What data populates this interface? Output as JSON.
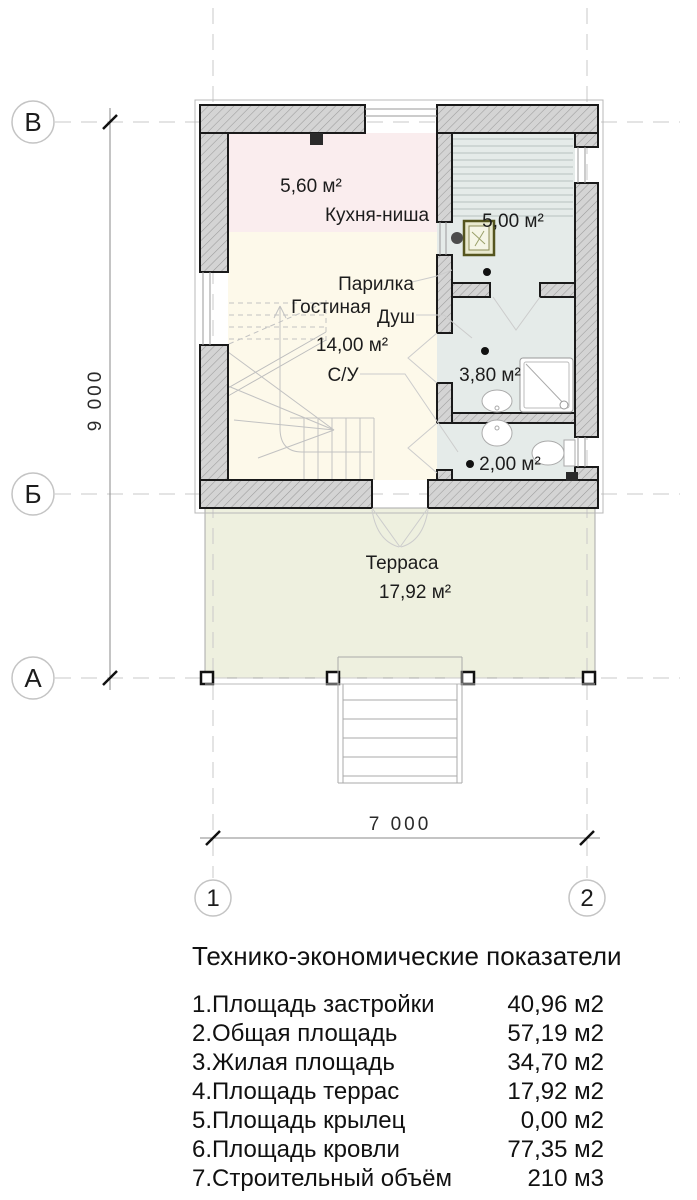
{
  "plan": {
    "axis_rows": [
      {
        "label": "В"
      },
      {
        "label": "Б"
      },
      {
        "label": "А"
      }
    ],
    "axis_cols": [
      {
        "label": "1"
      },
      {
        "label": "2"
      }
    ],
    "dim_height": "9 000",
    "dim_width": "7 000",
    "rooms": [
      {
        "name": "Кухня-ниша",
        "area": "5,60 м²"
      },
      {
        "name": "Парилка",
        "area": "5,00 м²"
      },
      {
        "name": "Гостиная",
        "area": "14,00 м²"
      },
      {
        "name": "Душ",
        "area": "3,80 м²"
      },
      {
        "name": "С/У",
        "area": "2,00 м²"
      },
      {
        "name": "Терраса",
        "area": "17,92 м²"
      }
    ],
    "colors": {
      "kitchen": "#faedee",
      "living": "#fdf9ea",
      "wet": "#e5ebe9",
      "terrace": "#eef0df"
    }
  },
  "table": {
    "title": "Технико-экономические показатели",
    "rows": [
      {
        "label": "1.Площадь застройки",
        "value": "40,96 м2"
      },
      {
        "label": "2.Общая площадь",
        "value": "57,19 м2"
      },
      {
        "label": "3.Жилая площадь",
        "value": "34,70 м2"
      },
      {
        "label": "4.Площадь террас",
        "value": "17,92 м2"
      },
      {
        "label": "5.Площадь крылец",
        "value": "0,00 м2"
      },
      {
        "label": "6.Площадь кровли",
        "value": "77,35 м2"
      },
      {
        "label": "7.Строительный объём",
        "value": "210 м3"
      }
    ]
  }
}
